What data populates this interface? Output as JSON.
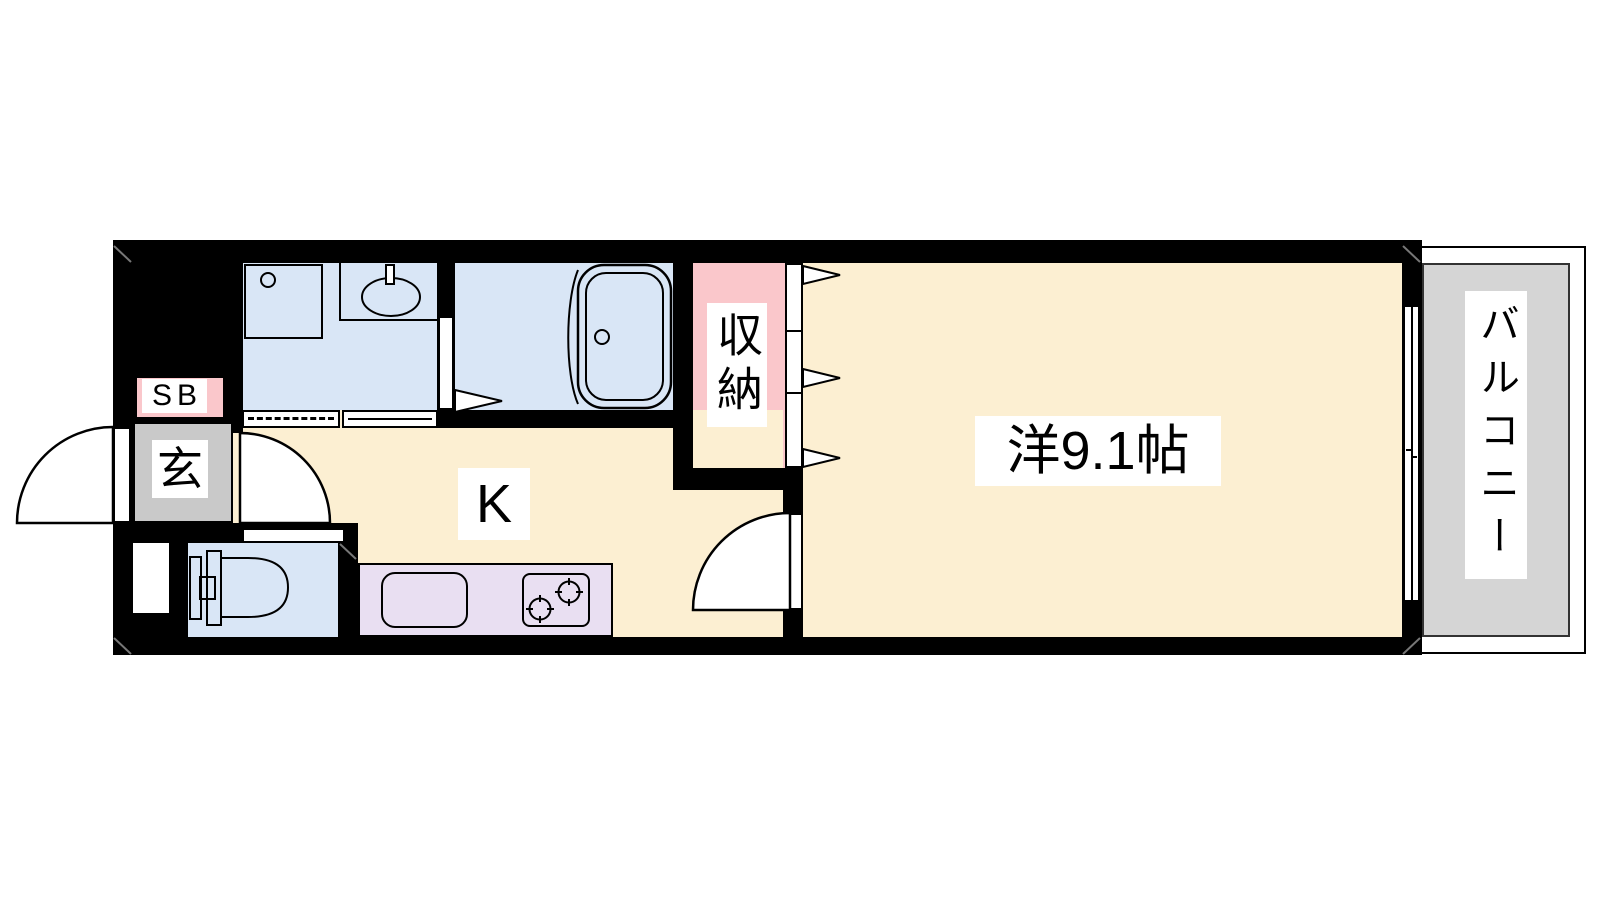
{
  "floor_plan": {
    "labels": {
      "shoe_box": "SB",
      "entrance": "玄",
      "kitchen": "K",
      "storage": "収納",
      "western_room": "洋9.1帖",
      "balcony": "バルコニー"
    },
    "fixtures": [
      "washing-machine-pan",
      "washbasin",
      "bathtub",
      "toilet",
      "kitchen-sink",
      "gas-stove"
    ],
    "doors": [
      "entrance-swing-door",
      "washroom-accordion-door",
      "washroom-sliding-door",
      "bath-folding-door",
      "closet-folding-door",
      "kitchen-swing-door",
      "room-swing-door",
      "toilet-door",
      "balcony-sliding-window"
    ],
    "colors": {
      "wall_black": "#000000",
      "floor_cream": "#FCEFD2",
      "wet_area_blue": "#D9E6F6",
      "accent_pink": "#FAC7CB",
      "entrance_gray": "#C9C9C9",
      "balcony_gray": "#D5D5D5",
      "counter_purple": "#E9DFF2"
    }
  }
}
